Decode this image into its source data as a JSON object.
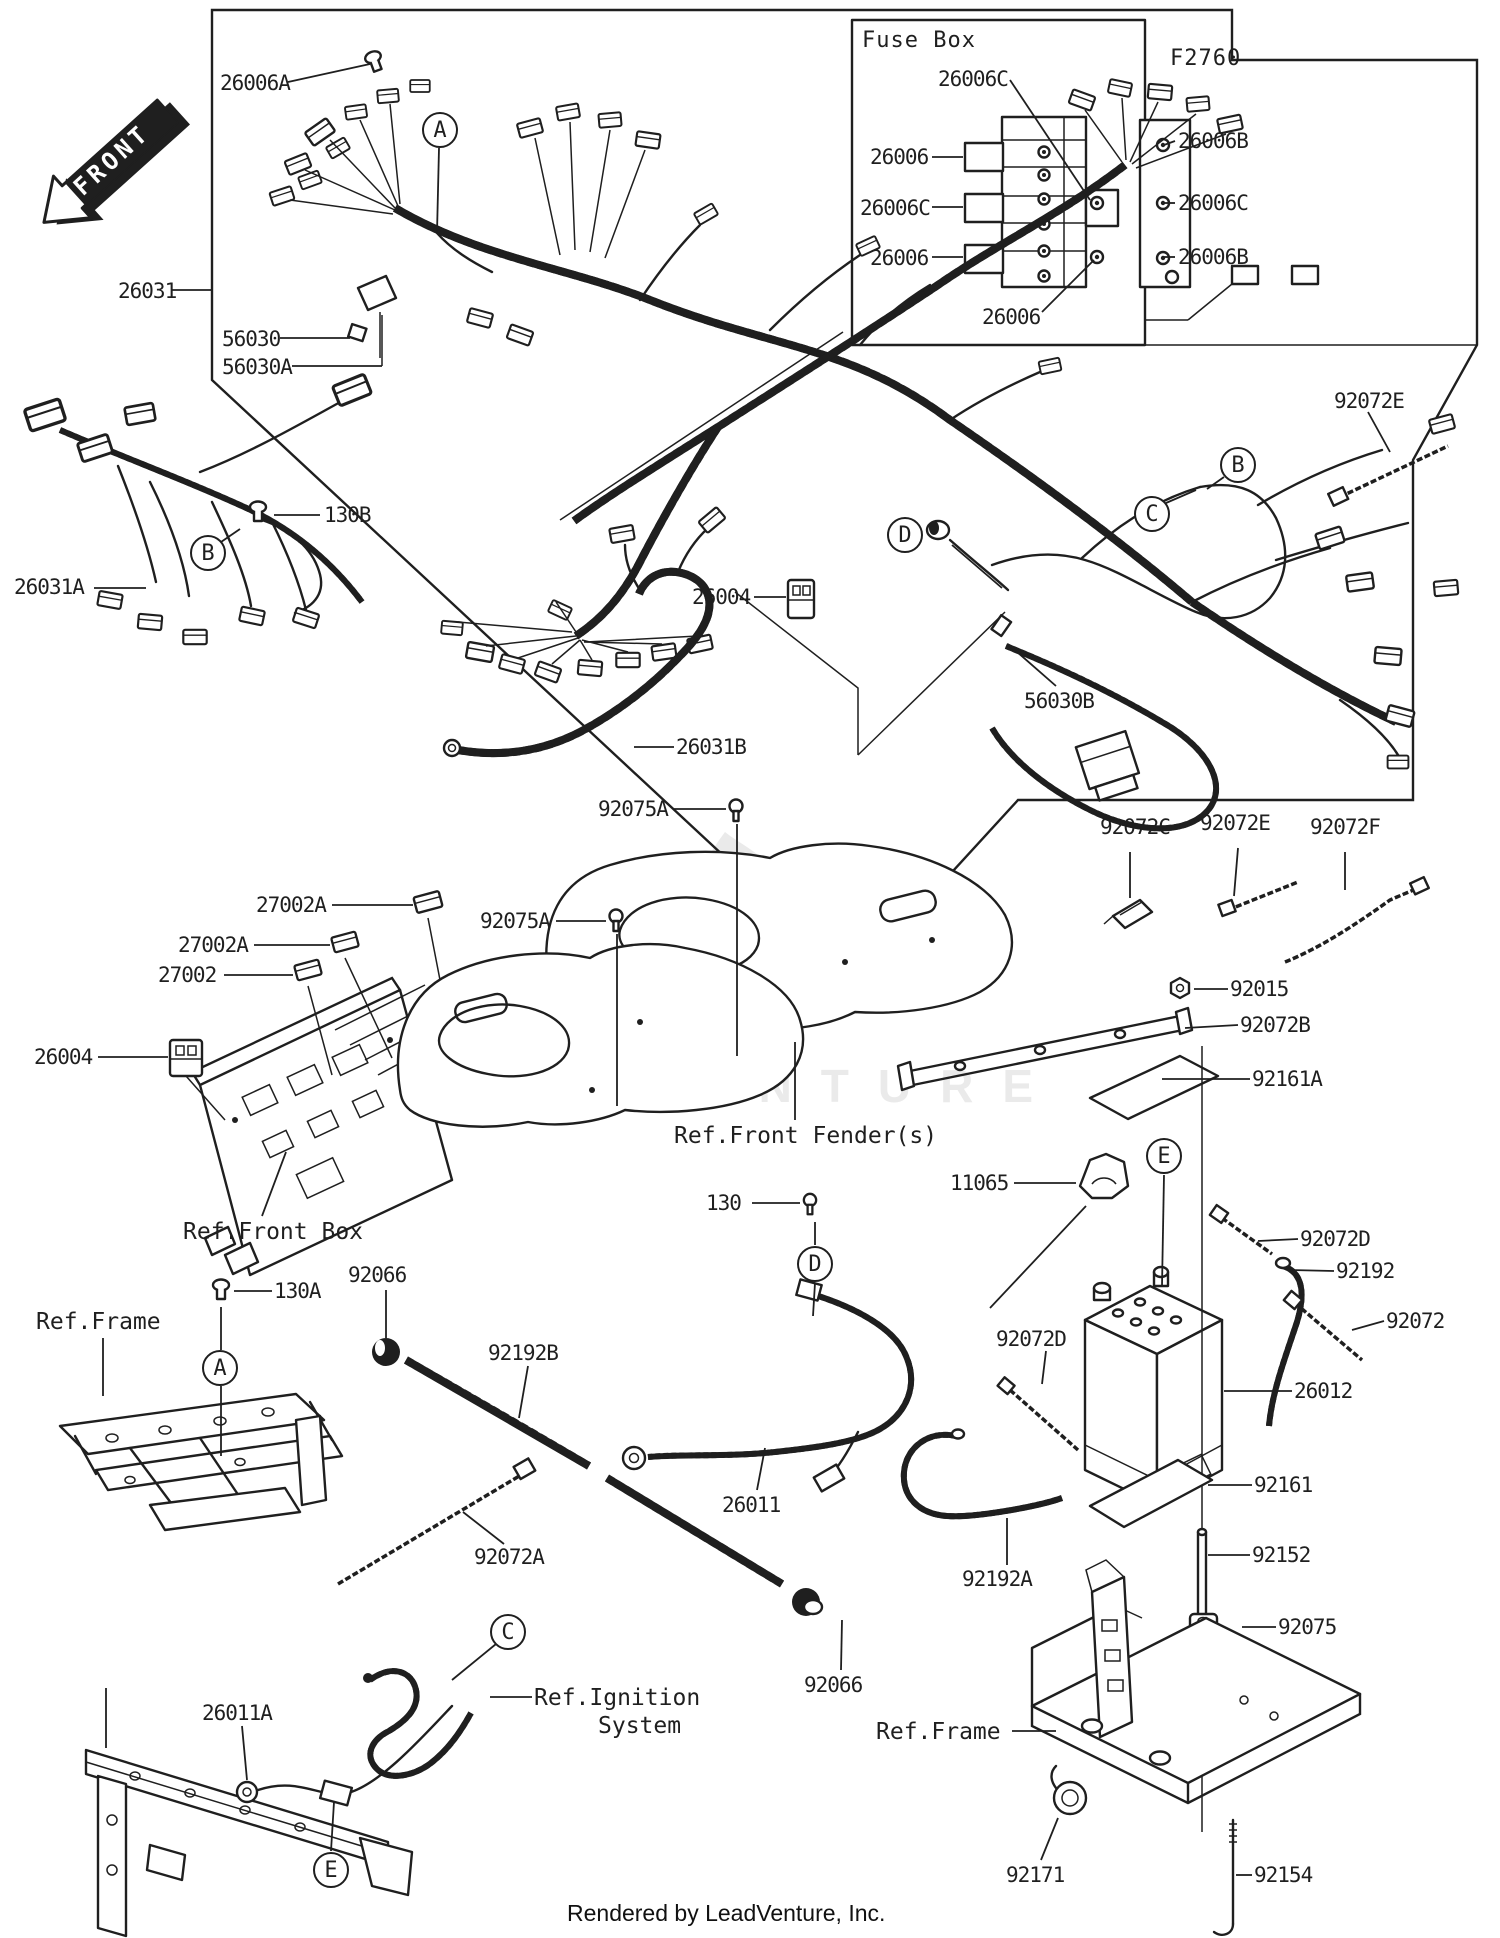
{
  "front_arrow": {
    "label": "FRONT"
  },
  "fuse_box": {
    "title": "Fuse Box",
    "code": "F2760"
  },
  "watermark": {
    "text": "LEADVENTURE"
  },
  "footer": {
    "text": "Rendered by LeadVenture, Inc."
  },
  "part_labels": [
    {
      "text": "26006A",
      "x": 220,
      "y": 72,
      "kind": "part"
    },
    {
      "text": "26031",
      "x": 118,
      "y": 280,
      "kind": "part"
    },
    {
      "text": "56030",
      "x": 222,
      "y": 328,
      "kind": "part"
    },
    {
      "text": "56030A",
      "x": 222,
      "y": 356,
      "kind": "part"
    },
    {
      "text": "26006C",
      "x": 938,
      "y": 68,
      "kind": "part"
    },
    {
      "text": "26006",
      "x": 870,
      "y": 146,
      "kind": "part"
    },
    {
      "text": "26006C",
      "x": 860,
      "y": 197,
      "kind": "part"
    },
    {
      "text": "26006",
      "x": 870,
      "y": 247,
      "kind": "part"
    },
    {
      "text": "26006B",
      "x": 1178,
      "y": 130,
      "kind": "part"
    },
    {
      "text": "26006C",
      "x": 1178,
      "y": 192,
      "kind": "part"
    },
    {
      "text": "26006B",
      "x": 1178,
      "y": 246,
      "kind": "part"
    },
    {
      "text": "26006",
      "x": 982,
      "y": 306,
      "kind": "part"
    },
    {
      "text": "92072E",
      "x": 1334,
      "y": 390,
      "kind": "part"
    },
    {
      "text": "26031A",
      "x": 14,
      "y": 576,
      "kind": "part"
    },
    {
      "text": "130B",
      "x": 324,
      "y": 504,
      "kind": "part"
    },
    {
      "text": "26004",
      "x": 692,
      "y": 586,
      "kind": "part"
    },
    {
      "text": "56030B",
      "x": 1024,
      "y": 690,
      "kind": "part"
    },
    {
      "text": "26031B",
      "x": 676,
      "y": 736,
      "kind": "part"
    },
    {
      "text": "92075A",
      "x": 598,
      "y": 798,
      "kind": "part"
    },
    {
      "text": "92075A",
      "x": 480,
      "y": 910,
      "kind": "part"
    },
    {
      "text": "27002A",
      "x": 256,
      "y": 894,
      "kind": "part"
    },
    {
      "text": "27002A",
      "x": 178,
      "y": 934,
      "kind": "part"
    },
    {
      "text": "27002",
      "x": 158,
      "y": 964,
      "kind": "part"
    },
    {
      "text": "26004",
      "x": 34,
      "y": 1046,
      "kind": "part"
    },
    {
      "text": "Ref.Front Box",
      "x": 183,
      "y": 1220,
      "kind": "ref"
    },
    {
      "text": "Ref.Front Fender(s)",
      "x": 674,
      "y": 1124,
      "kind": "ref"
    },
    {
      "text": "11065",
      "x": 950,
      "y": 1172,
      "kind": "part"
    },
    {
      "text": "92015",
      "x": 1230,
      "y": 978,
      "kind": "part"
    },
    {
      "text": "92072B",
      "x": 1240,
      "y": 1014,
      "kind": "part"
    },
    {
      "text": "92161A",
      "x": 1252,
      "y": 1068,
      "kind": "part"
    },
    {
      "text": "92072C",
      "x": 1100,
      "y": 816,
      "kind": "part"
    },
    {
      "text": "92072E",
      "x": 1200,
      "y": 812,
      "kind": "part"
    },
    {
      "text": "92072F",
      "x": 1310,
      "y": 816,
      "kind": "part"
    },
    {
      "text": "92072D",
      "x": 1300,
      "y": 1228,
      "kind": "part"
    },
    {
      "text": "92192",
      "x": 1336,
      "y": 1260,
      "kind": "part"
    },
    {
      "text": "92072",
      "x": 1386,
      "y": 1310,
      "kind": "part"
    },
    {
      "text": "26012",
      "x": 1294,
      "y": 1380,
      "kind": "part"
    },
    {
      "text": "92072D",
      "x": 996,
      "y": 1328,
      "kind": "part"
    },
    {
      "text": "92161",
      "x": 1254,
      "y": 1474,
      "kind": "part"
    },
    {
      "text": "92152",
      "x": 1252,
      "y": 1544,
      "kind": "part"
    },
    {
      "text": "92075",
      "x": 1278,
      "y": 1616,
      "kind": "part"
    },
    {
      "text": "92192A",
      "x": 962,
      "y": 1568,
      "kind": "part"
    },
    {
      "text": "Ref.Frame",
      "x": 876,
      "y": 1720,
      "kind": "ref"
    },
    {
      "text": "92171",
      "x": 1006,
      "y": 1864,
      "kind": "part"
    },
    {
      "text": "92154",
      "x": 1254,
      "y": 1864,
      "kind": "part"
    },
    {
      "text": "Ref.Frame",
      "x": 36,
      "y": 1310,
      "kind": "ref"
    },
    {
      "text": "130A",
      "x": 274,
      "y": 1280,
      "kind": "part"
    },
    {
      "text": "92066",
      "x": 348,
      "y": 1264,
      "kind": "part"
    },
    {
      "text": "92192B",
      "x": 488,
      "y": 1342,
      "kind": "part"
    },
    {
      "text": "92072A",
      "x": 474,
      "y": 1546,
      "kind": "part"
    },
    {
      "text": "130",
      "x": 706,
      "y": 1192,
      "kind": "part"
    },
    {
      "text": "26011",
      "x": 722,
      "y": 1494,
      "kind": "part"
    },
    {
      "text": "92066",
      "x": 804,
      "y": 1674,
      "kind": "part"
    },
    {
      "text": "26011A",
      "x": 202,
      "y": 1702,
      "kind": "part"
    },
    {
      "text": "Ref.Ignition",
      "x": 534,
      "y": 1686,
      "kind": "ref"
    },
    {
      "text": "System",
      "x": 598,
      "y": 1714,
      "kind": "ref"
    }
  ],
  "callouts": [
    {
      "letter": "A",
      "x": 440,
      "y": 130
    },
    {
      "letter": "B",
      "x": 208,
      "y": 553
    },
    {
      "letter": "B",
      "x": 1238,
      "y": 465
    },
    {
      "letter": "C",
      "x": 1152,
      "y": 514
    },
    {
      "letter": "D",
      "x": 905,
      "y": 535
    },
    {
      "letter": "E",
      "x": 1164,
      "y": 1156
    },
    {
      "letter": "D",
      "x": 815,
      "y": 1264
    },
    {
      "letter": "A",
      "x": 220,
      "y": 1368
    },
    {
      "letter": "C",
      "x": 508,
      "y": 1632
    },
    {
      "letter": "E",
      "x": 331,
      "y": 1870
    }
  ]
}
